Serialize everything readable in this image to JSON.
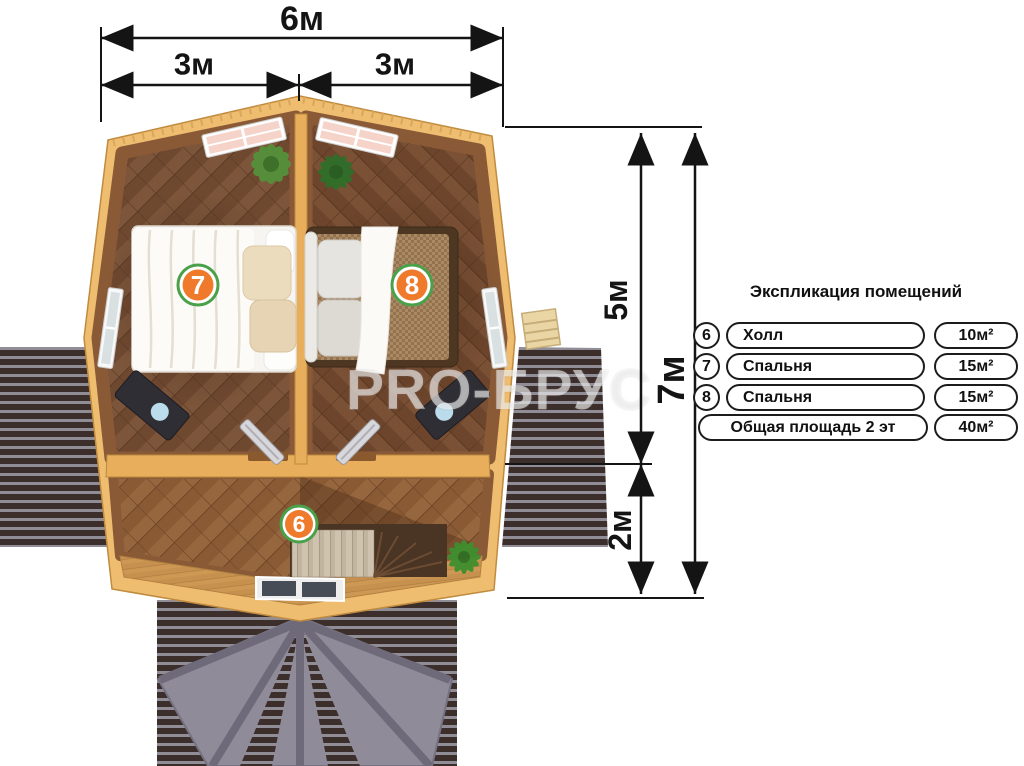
{
  "plan": {
    "watermark": "PRO-БРУС",
    "badges": {
      "hall": "6",
      "bedroom_left": "7",
      "bedroom_right": "8"
    }
  },
  "dimensions": {
    "top_total": "6м",
    "top_left_half": "3м",
    "top_right_half": "3м",
    "right_upper": "5м",
    "right_lower": "2м",
    "right_total": "7м"
  },
  "legend": {
    "title": "Экспликация помещений",
    "rows": [
      {
        "num": "6",
        "name": "Холл",
        "area": "10м²"
      },
      {
        "num": "7",
        "name": "Спальня",
        "area": "15м²"
      },
      {
        "num": "8",
        "name": "Спальня",
        "area": "15м²"
      }
    ],
    "total_row": {
      "name": "Общая площадь 2 эт",
      "area": "40м²"
    }
  },
  "colors": {
    "badge_orange": "#ef7a2b",
    "badge_ring_green": "#4ba04a",
    "wall_wood": "#e8ae5b",
    "eaves_wood": "#efbd70",
    "bedroom_floor": "#6f4830",
    "hall_floor": "#8a5a35",
    "balcony_floor": "#c6914e",
    "porch_roof_grey": "#8f8b98",
    "deck_stripe_dark": "#3c2e2a",
    "deck_stripe_light": "#908d97",
    "dimension_line": "#141414"
  }
}
